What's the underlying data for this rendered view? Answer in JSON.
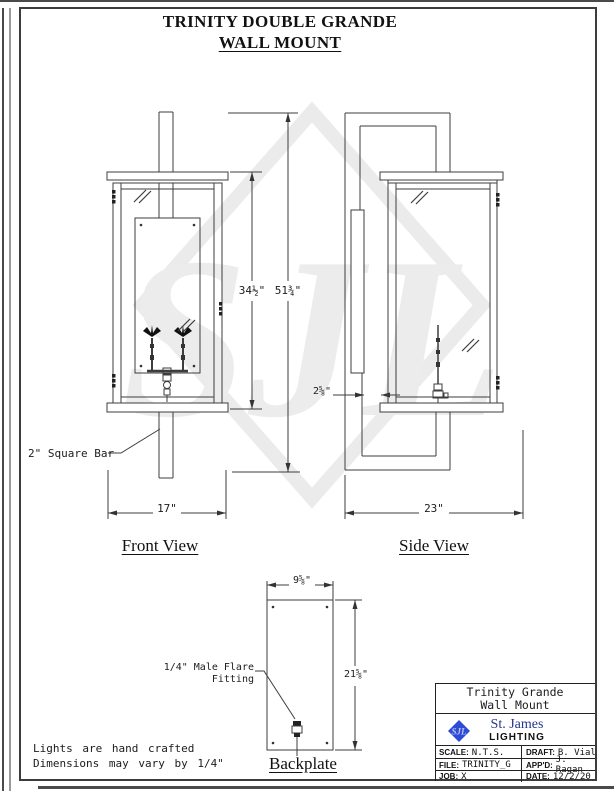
{
  "page": {
    "title_line1": "TRINITY DOUBLE GRANDE",
    "title_line2": "WALL MOUNT"
  },
  "watermark": {
    "monogram": "SJL"
  },
  "views": {
    "front": {
      "label": "Front View",
      "width_dim": "17\"",
      "body_height_dim": "34½\"",
      "overall_height_dim": "51¾\"",
      "bar_note": "2\" Square Bar"
    },
    "side": {
      "label": "Side View",
      "width_dim": "23\"",
      "standoff_dim": "2⅝\""
    }
  },
  "backplate": {
    "label": "Backplate",
    "width_dim": "9⅝\"",
    "height_dim": "21⅝\"",
    "fitting_note_line1": "1/4\" Male Flare",
    "fitting_note_line2": "Fitting"
  },
  "notes": {
    "line1": "Lights are hand crafted",
    "line2": "Dimensions may vary by 1/4\""
  },
  "title_block": {
    "product_line1": "Trinity Grande",
    "product_line2": "Wall Mount",
    "logo_monogram": "SJL",
    "company_name": "St. James",
    "company_division": "LIGHTING",
    "fields": {
      "scale": {
        "label": "SCALE:",
        "value": "N.T.S."
      },
      "draft": {
        "label": "DRAFT:",
        "value": "B. Vial"
      },
      "file": {
        "label": "FILE:",
        "value": "TRINITY_G"
      },
      "appd": {
        "label": "APP'D:",
        "value": "J. Ragan"
      },
      "job": {
        "label": "JOB:",
        "value": "X"
      },
      "date": {
        "label": "DATE:",
        "value": "12/2/20"
      }
    }
  },
  "colors": {
    "brand_blue": "#27348b",
    "logo_blue": "#2f4bd6",
    "line": "#3d3d3d",
    "watermark": "#e9e9e9"
  }
}
